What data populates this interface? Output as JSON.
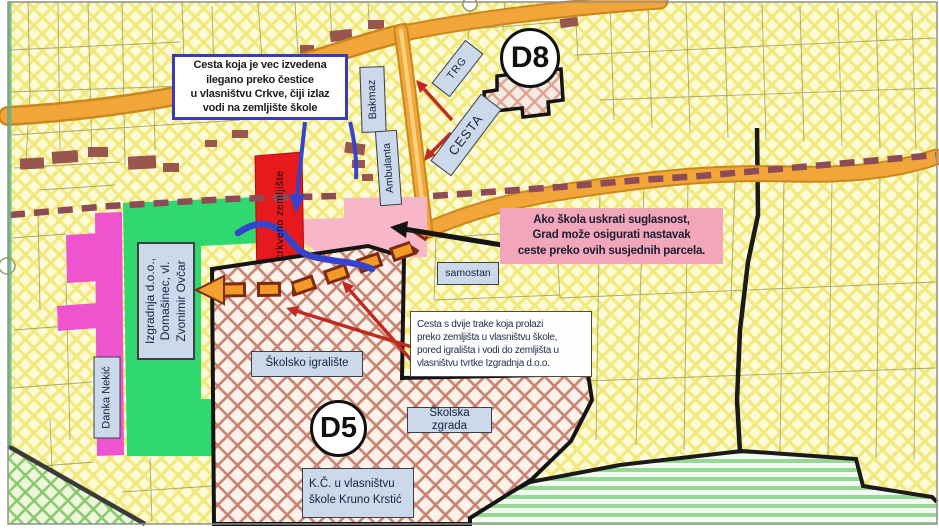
{
  "map": {
    "circles": {
      "d8": "D8",
      "d5": "D5"
    },
    "notes": {
      "illegal_road": "Cesta koja je vec izvedena\nilegano preko čestice\nu vlasništvu Crkve, čiji izlaz\nvodi na zemljište škole",
      "city_fallback": "Ako škola uskrati suglasnost,\nGrad može osigurati nastavak\nceste preko ovih susjednih parcela.",
      "two_lane_road": "Cesta s dvije trake koja prolazi\npreko zemljišta u vlasništvu škole,\npored igrališta i vodi do zemljišta u\nvlasništvu tvrtke Izgradnja d.o.o."
    },
    "labels": {
      "bakmaz": "Bakmaz",
      "ambulanta": "Ambulanta",
      "trg": "TRG",
      "cesta": "CESTA",
      "samostan": "samostan",
      "school_playground": "Školsko igralište",
      "school_building": "Školska zgrada",
      "school_parcel": "K.Č. u vlasništvu\nškole Kruno Krstić",
      "izgradnja_owner": "Izgradnja d.o.o.,\nDomašinec, vl.\nZvonimir Ovčar",
      "danka_nekic": "Danka Nekić",
      "church_land": "crkveno zemljište"
    },
    "colors": {
      "road_orange": "#f2a63a",
      "planned_route_orange": "#f29a28",
      "green_zone": "#2fd96f",
      "magenta_zone": "#ee54cd",
      "church_red": "#e6191d",
      "pink_zone": "#f7b7c9",
      "note_pink_bg": "#f2a6bc",
      "note_blue_border": "#3a3ab5",
      "blue_road": "#3643cd",
      "red_arrow": "#bf2a22",
      "label_bg": "#cbd9eb"
    }
  }
}
